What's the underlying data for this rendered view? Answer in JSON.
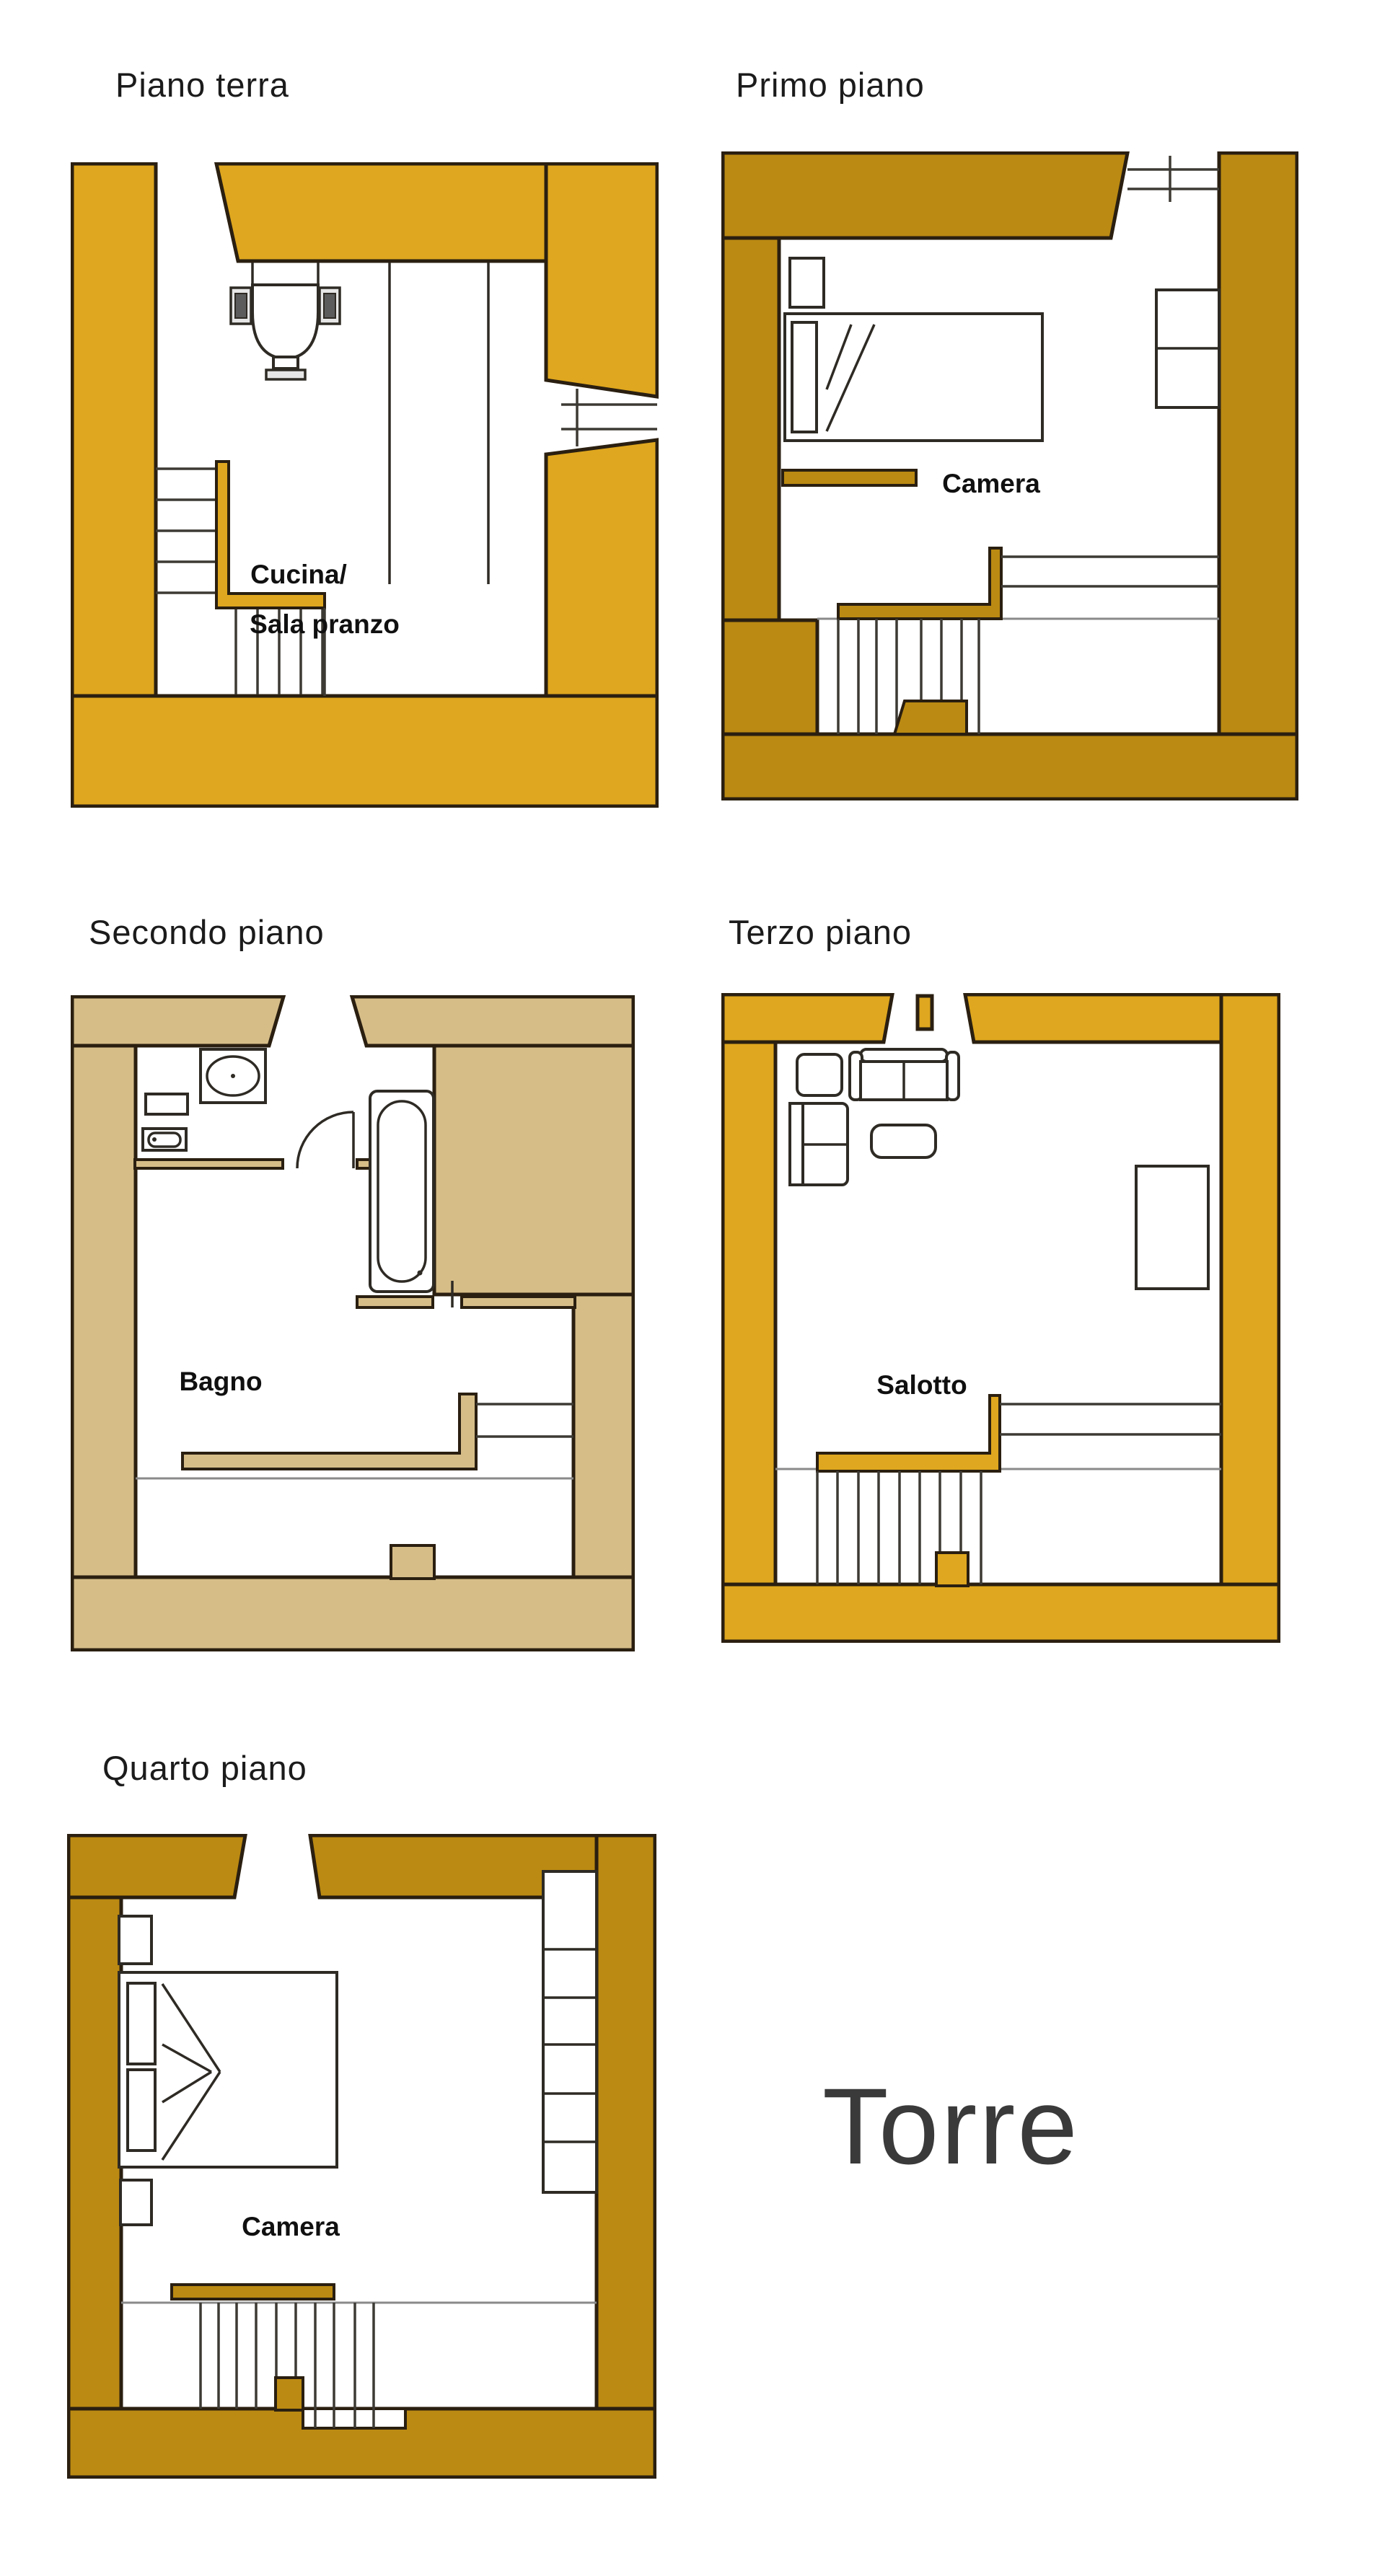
{
  "page": {
    "background": "#FFFFFF",
    "kind": "floor-plan-sheet"
  },
  "colors": {
    "wall-gold": "#DFA71F",
    "wall-dark-gold": "#BB8A12",
    "wall-tan": "#D6BD88",
    "outline": "#2A1F10",
    "label-text": "#101010",
    "title-text": "#1B1B1B",
    "torre-text": "#3A3A3A",
    "page-bg": "#FFFFFF"
  },
  "torre_label": "Torre",
  "floors": [
    {
      "title": "Piano terra",
      "room_labels": [
        "Cucina/",
        "Sala pranzo"
      ],
      "wall_color": "#DFA71F",
      "icons": [
        "stove-icon",
        "window-icon",
        "staircase",
        "banister"
      ]
    },
    {
      "title": "Primo piano",
      "room_labels": [
        "Camera"
      ],
      "wall_color": "#BB8A12",
      "icons": [
        "single-bed-icon",
        "nightstand-icon",
        "wardrobe-icon",
        "window-icon",
        "staircase",
        "banister"
      ]
    },
    {
      "title": "Secondo piano",
      "room_labels": [
        "Bagno"
      ],
      "wall_color": "#D6BD88",
      "icons": [
        "sink-icon",
        "shelf-icon",
        "bidet-icon",
        "bathtub-icon",
        "door-icon",
        "staircase",
        "banister"
      ]
    },
    {
      "title": "Terzo piano",
      "room_labels": [
        "Salotto"
      ],
      "wall_color": "#DFA71F",
      "icons": [
        "armchair-icon",
        "sofa-icon",
        "chaise-icon",
        "coffee-table-icon",
        "cabinet-icon",
        "staircase",
        "banister"
      ]
    },
    {
      "title": "Quarto piano",
      "room_labels": [
        "Camera"
      ],
      "wall_color": "#BB8A12",
      "icons": [
        "double-bed-icon",
        "nightstand-icon",
        "shelving-icon",
        "staircase",
        "banister"
      ]
    }
  ]
}
